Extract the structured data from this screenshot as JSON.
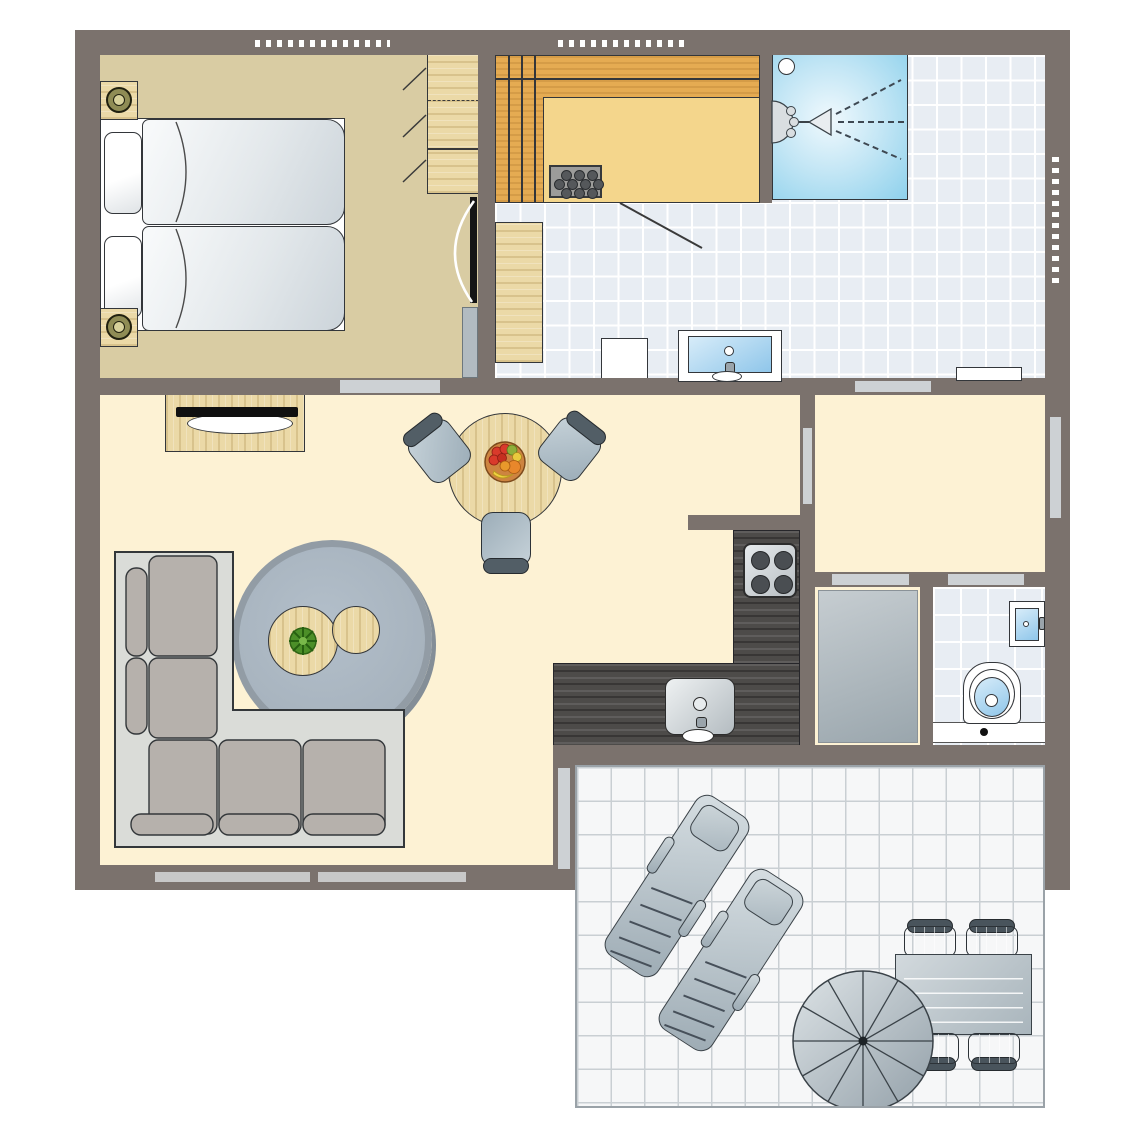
{
  "scene": {
    "type": "floor-plan",
    "description": "holiday-cottage top-view floor plan with terrace",
    "visible_text": []
  },
  "palette": {
    "wall": "#7b726d",
    "outline": "#33363a",
    "bedroom_floor": "#d9cca3",
    "living_floor": "#fdf2d4",
    "bath_tile": "#e8edf3",
    "bath_grid": "#ffffff",
    "terrace_tile": "#f6f7f8",
    "terrace_grid": "#c9cfd3",
    "wood": "#ebd9a7",
    "sauna_bench": "#e5ab52",
    "sauna_floor": "#f4d68c",
    "shower_blue": "#8ed1ec",
    "furniture_gray": "#aebfca",
    "furniture_gray_dark": "#525e66",
    "rug": "#aab6c1",
    "sofa_base": "#dadcd8",
    "sofa_cushion": "#b6b1ac",
    "counter": "#4d4b49",
    "door_bar": "#cdd1d4",
    "lamp_olive": "#8f8c55",
    "plant_green": "#4c8f28",
    "fruit_red": "#d93a2b",
    "fruit_orange": "#e8872b",
    "fruit_yellow": "#f0d040"
  },
  "counts": {
    "heater_stone_rows": [
      3,
      4,
      3
    ],
    "hob_burners": 4,
    "dining_chairs": 3,
    "terrace_chairs": 4,
    "sun_loungers": 2,
    "parasol_segments": 12
  },
  "rooms": [
    {
      "id": "bedroom",
      "furniture": [
        "double-bed",
        "pillows",
        "duvets",
        "nightstand-top",
        "nightstand-bottom",
        "table-lamps",
        "wardrobe",
        "radiator",
        "door"
      ]
    },
    {
      "id": "bathroom",
      "furniture": [
        "sauna",
        "sauna-heater",
        "shower",
        "shower-head",
        "wooden-bench",
        "stool",
        "washbasin",
        "radiator",
        "window"
      ]
    },
    {
      "id": "living-room",
      "furniture": [
        "sideboard",
        "tv",
        "round-dining-table",
        "fruit-bowl",
        "dining-chairs",
        "round-rug",
        "coffee-table-large",
        "coffee-table-small",
        "plant",
        "corner-sofa",
        "windows",
        "terrace-slider"
      ]
    },
    {
      "id": "hallway",
      "furniture": [
        "entrance-door",
        "door-openings"
      ]
    },
    {
      "id": "kitchen",
      "furniture": [
        "l-shaped-counter",
        "hob",
        "sink"
      ]
    },
    {
      "id": "storage-room",
      "furniture": [
        "storage-unit"
      ]
    },
    {
      "id": "toilet-room",
      "furniture": [
        "toilet",
        "hand-basin"
      ]
    },
    {
      "id": "terrace",
      "furniture": [
        "sun-loungers",
        "parasol",
        "outdoor-table",
        "outdoor-chairs"
      ]
    }
  ]
}
